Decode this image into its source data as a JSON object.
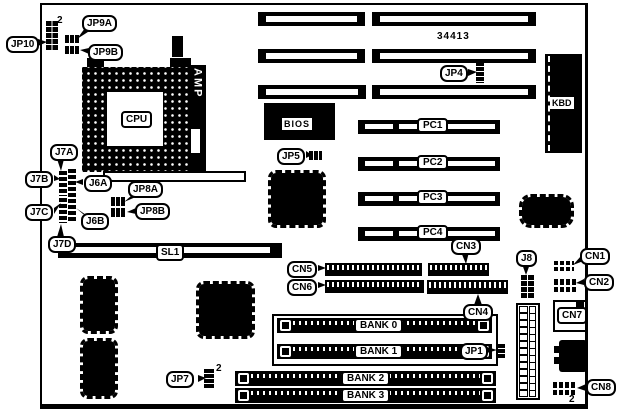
{
  "diagram": {
    "part_number": "34413",
    "pin2_marker": "2",
    "colors": {
      "ink": "#000000",
      "paper": "#ffffff"
    },
    "callouts": {
      "jp10": "JP10",
      "jp9a": "JP9A",
      "jp9b": "JP9B",
      "j7a": "J7A",
      "j7b": "J7B",
      "j7c": "J7C",
      "j7d": "J7D",
      "j6a": "J6A",
      "j6b": "J6B",
      "jp8a": "JP8A",
      "jp8b": "JP8B",
      "jp4": "JP4",
      "jp5": "JP5",
      "jp7": "JP7",
      "jp1": "JP1",
      "j8": "J8",
      "cn1": "CN1",
      "cn2": "CN2",
      "cn3": "CN3",
      "cn4": "CN4",
      "cn5": "CN5",
      "cn6": "CN6",
      "cn7": "CN7",
      "cn8": "CN8"
    },
    "components": {
      "cpu": "CPU",
      "amp": "AMP",
      "bios": "BIOS",
      "kbd": "KBD",
      "sl1": "SL1"
    },
    "slots": {
      "pc1": "PC1",
      "pc2": "PC2",
      "pc3": "PC3",
      "pc4": "PC4"
    },
    "memory_banks": [
      "BANK 0",
      "BANK 1",
      "BANK 2",
      "BANK 3"
    ]
  }
}
